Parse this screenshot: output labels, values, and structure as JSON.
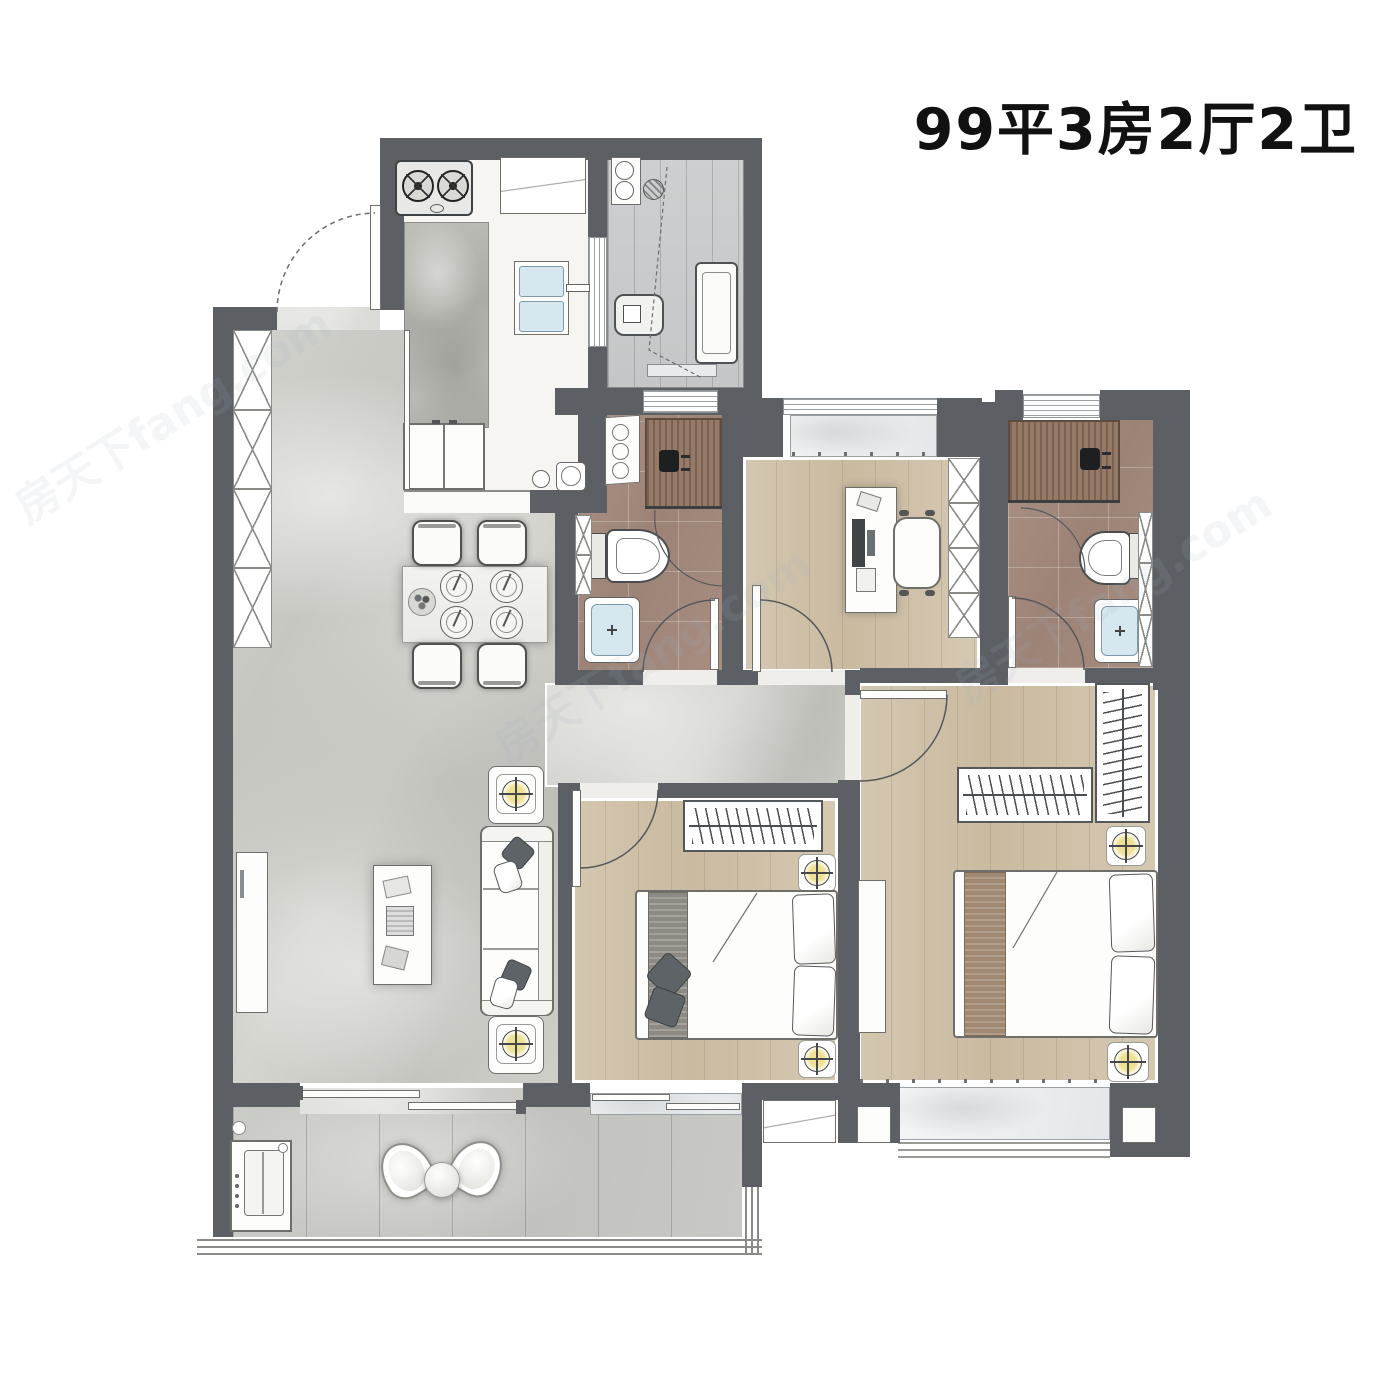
{
  "title": "99平3房2厅2卫",
  "watermark": "房天下fang.com",
  "colors": {
    "wall": "#5c6064",
    "marble_floor": "#cccdc8",
    "wood_floor": "#cfc2ab",
    "bath_floor": "#a78e81",
    "shower_tile": "#8c7060",
    "kitchen_floor": "#f6f5f2",
    "utility_floor": "#c9cbcc",
    "island_counter": "#b3b3ad",
    "balcony_floor": "#c6c7c2",
    "lamp_glow": "#efe193",
    "basin_water": "#d6e7ef",
    "furniture_outline": "#6e6e6a",
    "title_text": "#111111"
  }
}
